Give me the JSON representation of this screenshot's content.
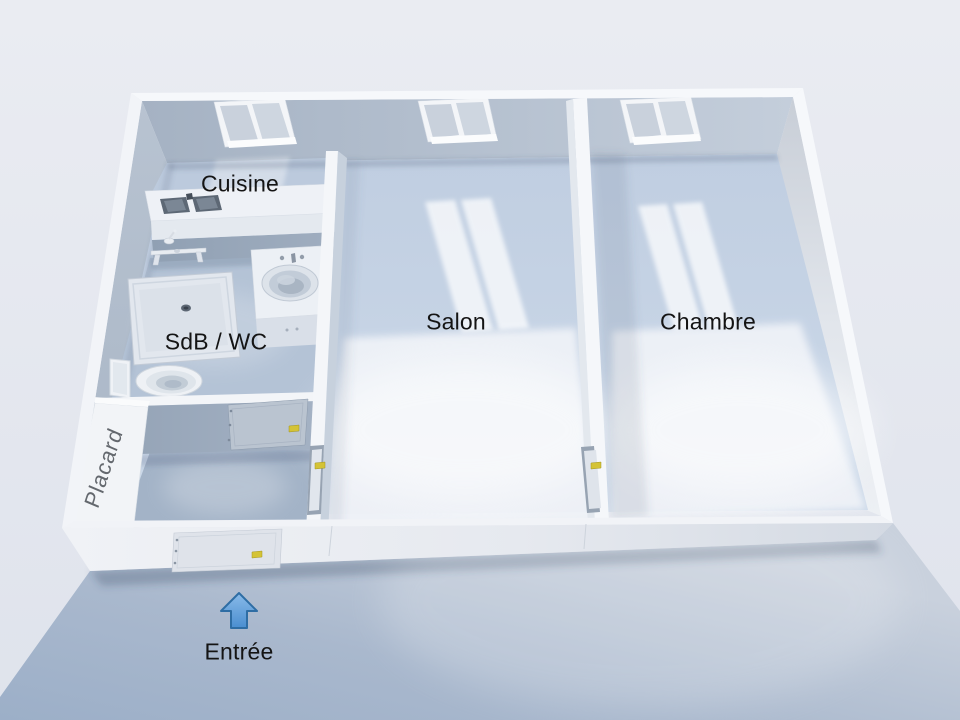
{
  "labels": {
    "cuisine": "Cuisine",
    "sdb_wc": "SdB / WC",
    "salon": "Salon",
    "chambre": "Chambre",
    "placard": "Placard",
    "entree": "Entrée"
  },
  "icons": {
    "entry_arrow": "up-arrow"
  },
  "colors": {
    "background": "#e7eaf1",
    "ground_shadow": "#a7b7cd",
    "floor": "#c6d3e5",
    "floor_highlight": "#f1f4f9",
    "wall_top": "#f5f7fa",
    "wall_face": "#b2bfcd",
    "door_handle": "#d4c336",
    "arrow_fill": "#5b9bd5",
    "arrow_border": "#2e6da4",
    "label_text": "#141414",
    "placard_text": "#64686e"
  }
}
